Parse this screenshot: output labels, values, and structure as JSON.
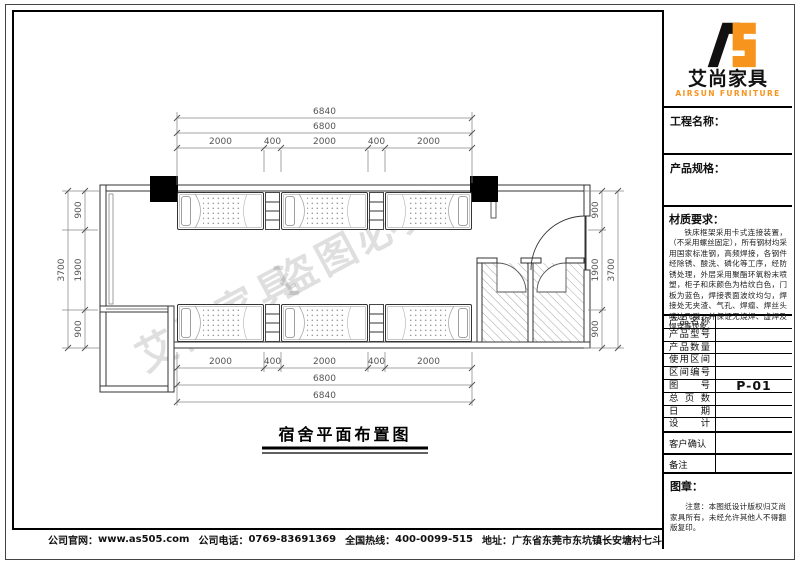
{
  "brand": {
    "name_cn": "艾尚家具",
    "name_en": "AIRSUN FURNITURE",
    "orange": "#F7941D",
    "black": "#111111"
  },
  "titleblock": {
    "project_label": "工程名称：",
    "spec_label": "产品规格：",
    "material_label": "材质要求：",
    "material_text": "铁床框架采用卡式连接装置，（不采用螺丝固定），所有钢材均采用国家标准钢，高频焊接，各钢件经除锈、酸洗、磷化等工序，经防锈处理，外层采用聚酯环氧粉末喷塑，柜子和床颜色为桔纹白色，门板为蓝色，焊接表面波纹均匀，焊接处无夹渣、气孔、焊瘤、焊丝头咬边飞溅，并保证无烧焊、虚焊及焊穿等现象。",
    "rows": [
      {
        "label": "产品名称",
        "value": ""
      },
      {
        "label": "产品型号",
        "value": ""
      },
      {
        "label": "产品数量",
        "value": ""
      },
      {
        "label": "使用区间",
        "value": ""
      },
      {
        "label": "区间编号",
        "value": ""
      },
      {
        "label": "图号",
        "value": "P-01"
      },
      {
        "label": "总页数",
        "value": ""
      },
      {
        "label": "日期",
        "value": ""
      },
      {
        "label": "设计",
        "value": ""
      }
    ],
    "confirm_label": "客户确认",
    "remark_label": "备注",
    "seal_label": "图章：",
    "seal_note": "注意：本图纸设计版权归艾尚家具所有，未经允许其他人不得翻版复印。"
  },
  "footer": {
    "website_label": "公司官网：",
    "website": "www.as505.com",
    "phone_label": "公司电话：",
    "phone": "0769-83691369",
    "hotline_label": "全国热线：",
    "hotline": "400-0099-515",
    "address_label": "地址：",
    "address": "广东省东莞市东坑镇长安塘村七斗种1号H座-D"
  },
  "plan": {
    "title": "宿舍平面布置图",
    "watermark_brand": "艾尚家具",
    "watermark_warn": "盗图必究",
    "dims": {
      "top_outer": "6840",
      "top_inner": "6800",
      "segments": [
        "2000",
        "400",
        "2000",
        "400",
        "2000"
      ],
      "bottom_inner": "6800",
      "bottom_outer": "6840",
      "side_segments": [
        "900",
        "1900",
        "900"
      ],
      "side_total": "3700"
    }
  }
}
